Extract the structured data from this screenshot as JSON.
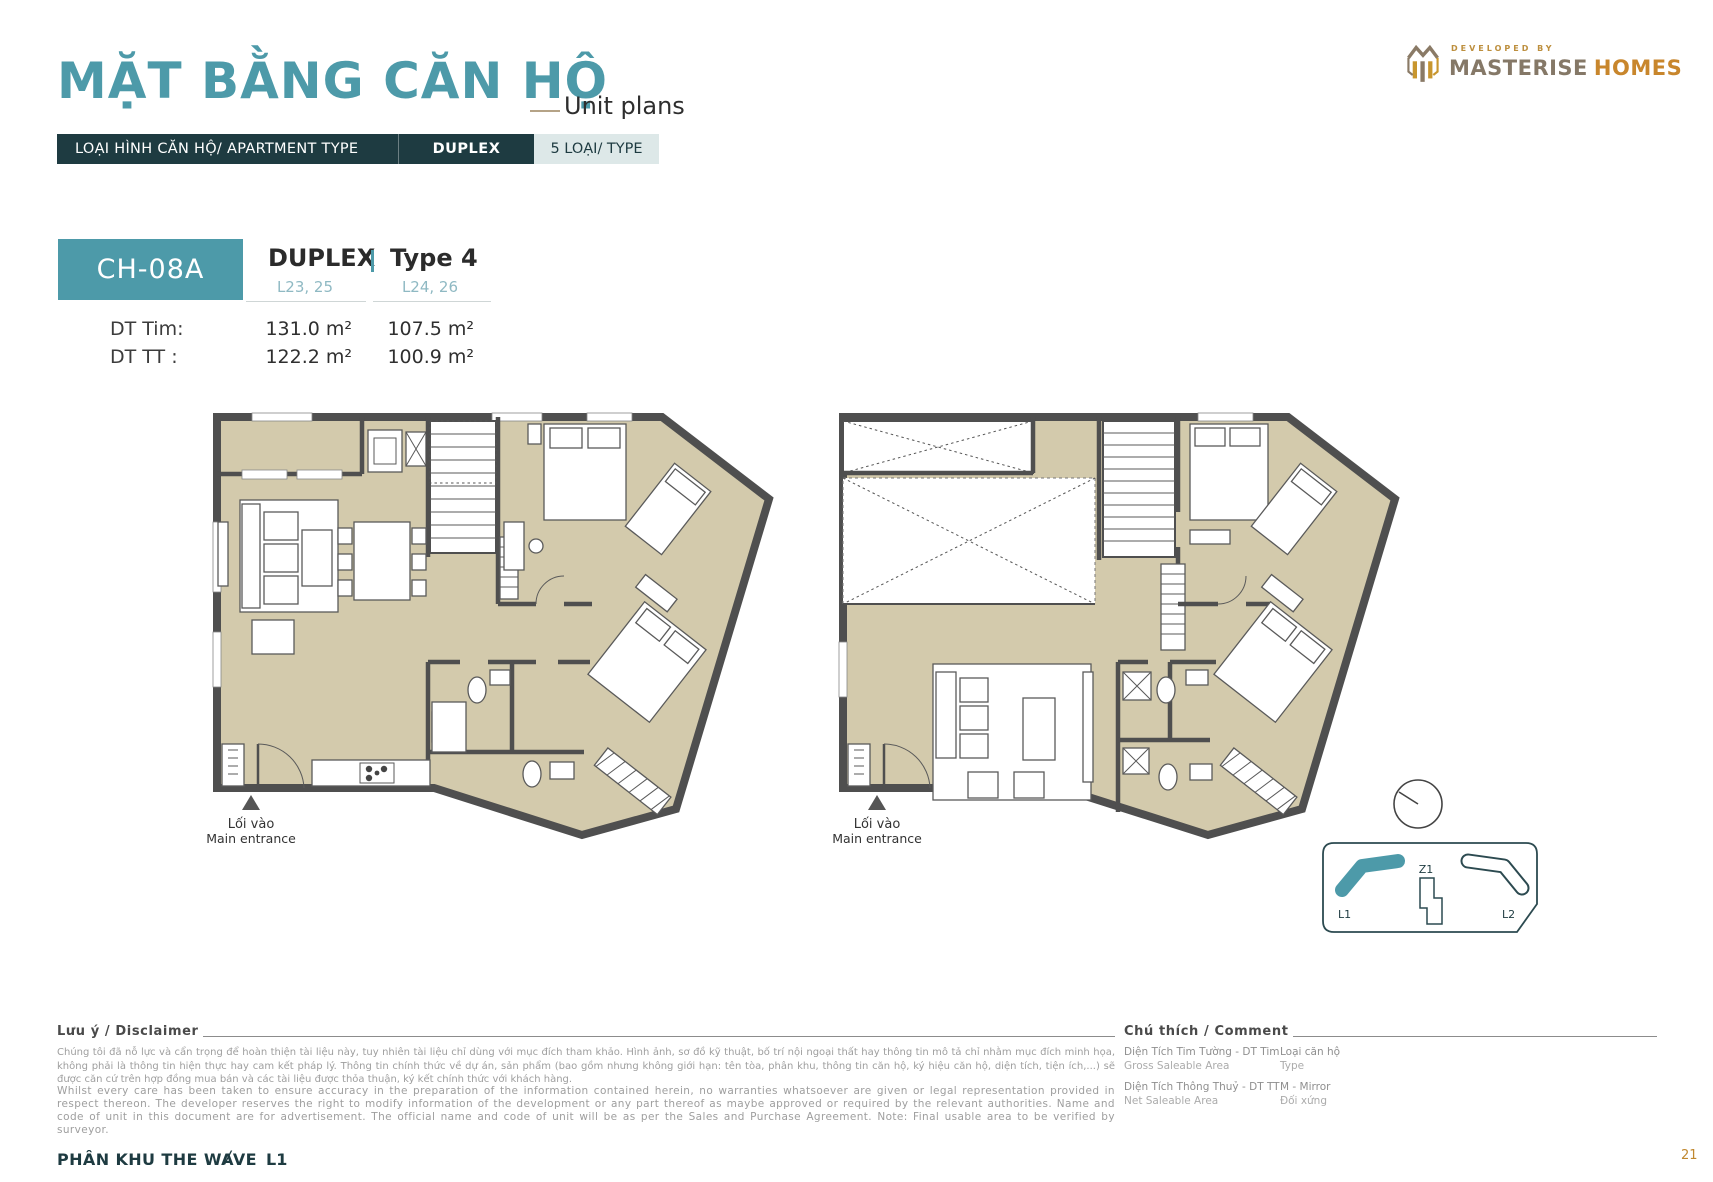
{
  "header": {
    "title": "MẶT BẰNG CĂN HỘ",
    "subtitle": "Unit plans",
    "logo": {
      "developed_by": "DEVELOPED BY",
      "brand_main": "MASTERISE",
      "brand_accent": "HOMES"
    }
  },
  "type_bar": {
    "label": "LOẠI HÌNH CĂN HỘ/ APARTMENT TYPE",
    "value": "DUPLEX",
    "count": "5 LOẠI/ TYPE"
  },
  "unit": {
    "code": "CH-08A",
    "type_name": "DUPLEX",
    "type_variant": "Type 4",
    "levels_col1": "L23, 25",
    "levels_col2": "L24, 26",
    "areas": [
      {
        "label": "DT Tim:",
        "col1": "131.0 m²",
        "col2": "107.5 m²"
      },
      {
        "label": "DT TT :",
        "col1": "122.2 m²",
        "col2": "100.9 m²"
      }
    ]
  },
  "plans": {
    "entrance_vi": "Lối vào",
    "entrance_en": "Main entrance"
  },
  "site_map": {
    "l1": "L1",
    "z1": "Z1",
    "l2": "L2"
  },
  "disclaimer": {
    "heading": "Lưu ý / Disclaimer",
    "vi": "Chúng tôi đã nỗ lực và cẩn trọng để hoàn thiện tài liệu này, tuy nhiên tài liệu chỉ dùng với mục đích tham khảo. Hình ảnh, sơ đồ kỹ thuật, bố trí nội ngoại thất hay thông tin mô tả chỉ nhằm mục đích minh họa, không phải là thông tin hiện thực hay cam kết pháp lý. Thông tin chính thức về dự án, sản phẩm (bao gồm nhưng không giới hạn: tên tòa, phân khu, thông tin căn hộ, ký hiệu căn hộ, diện tích, tiện ích,...) sẽ được căn cứ trên hợp đồng mua bán và các tài liệu được thỏa thuận, ký kết chính thức với khách hàng.",
    "en": "Whilst every care has been taken to ensure accuracy in the preparation of the information contained herein, no warranties whatsoever are given or legal representation provided in respect thereon. The developer reserves the right to modify information of the development or any part thereof as maybe approved or required by the relevant authorities. Name and code of unit in this document are for advertisement. The official name and code of unit will be as per the Sales and Purchase Agreement. Note: Final usable area to be verified by surveyor."
  },
  "legend": {
    "heading": "Chú thích / Comment",
    "items": [
      {
        "line1": "Diện Tích Tim Tường - DT Tim",
        "line2": "Gross Saleable Area"
      },
      {
        "line1": "Loại căn hộ",
        "line2": "Type"
      },
      {
        "line1": "Diện Tích Thông Thuỷ - DT TT",
        "line2": "Net Saleable Area"
      },
      {
        "line1": "M - Mirror",
        "line2": "Đối xứng"
      }
    ]
  },
  "footer": {
    "zone": "PHÂN KHU THE WAVE",
    "separator": "/",
    "level": "L1",
    "page": "21"
  },
  "colors": {
    "teal": "#4D9AA9",
    "dark_navy": "#1E3B41",
    "floor_beige": "#D3CAAC",
    "wall_gray": "#4F4F4F",
    "gold": "#C0882F"
  }
}
